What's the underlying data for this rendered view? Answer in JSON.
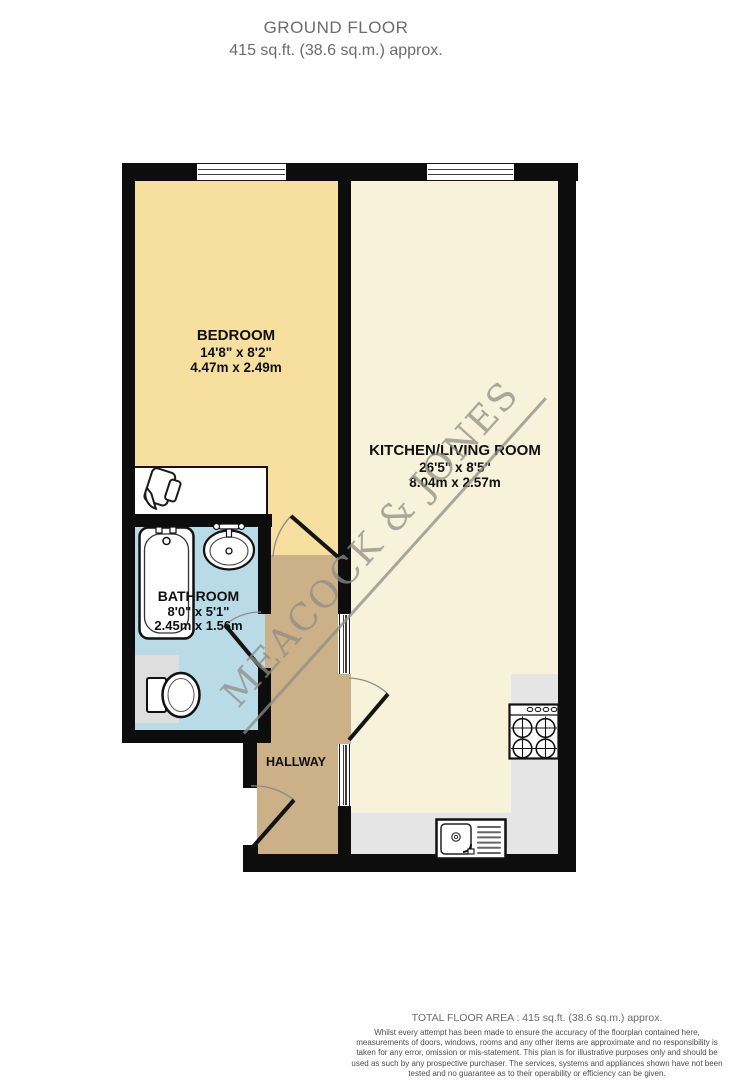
{
  "header": {
    "title": "GROUND FLOOR",
    "subtitle": "415 sq.ft. (38.6 sq.m.) approx."
  },
  "rooms": {
    "bedroom": {
      "name": "BEDROOM",
      "size_imperial": "14'8\" x 8'2\"",
      "size_metric": "4.47m x 2.49m"
    },
    "kitchen_living": {
      "name": "KITCHEN/LIVING ROOM",
      "size_imperial": "26'5\" x 8'5\"",
      "size_metric": "8.04m x 2.57m"
    },
    "bathroom": {
      "name": "BATHROOM",
      "size_imperial": "8'0\" x 5'1\"",
      "size_metric": "2.45m x 1.56m"
    },
    "hallway": {
      "name": "HALLWAY"
    }
  },
  "watermark": {
    "text": "MEACOCK & JONES"
  },
  "footer": {
    "total_area": "TOTAL FLOOR AREA : 415 sq.ft. (38.6 sq.m.) approx.",
    "disclaimer": "Whilst every attempt has been made to ensure the accuracy of the floorplan contained here, measurements of doors, windows, rooms and any other items are approximate and no responsibility is taken for any error, omission or mis-statement. This plan is for illustrative purposes only and should be used as such by any prospective purchaser. The services, systems and appliances shown have not been tested and no guarantee as to their operability or efficiency can be given.",
    "credit": "Made with Metropix ©2026"
  },
  "colors": {
    "bedroom": "#f7dfa0",
    "kitchen_living": "#f9f2da",
    "bathroom": "#b9dbe7",
    "hallway": "#cbb088",
    "wall": "#0d0d0d",
    "counter": "#e5e5e5",
    "watermark": "#8f8d85"
  }
}
